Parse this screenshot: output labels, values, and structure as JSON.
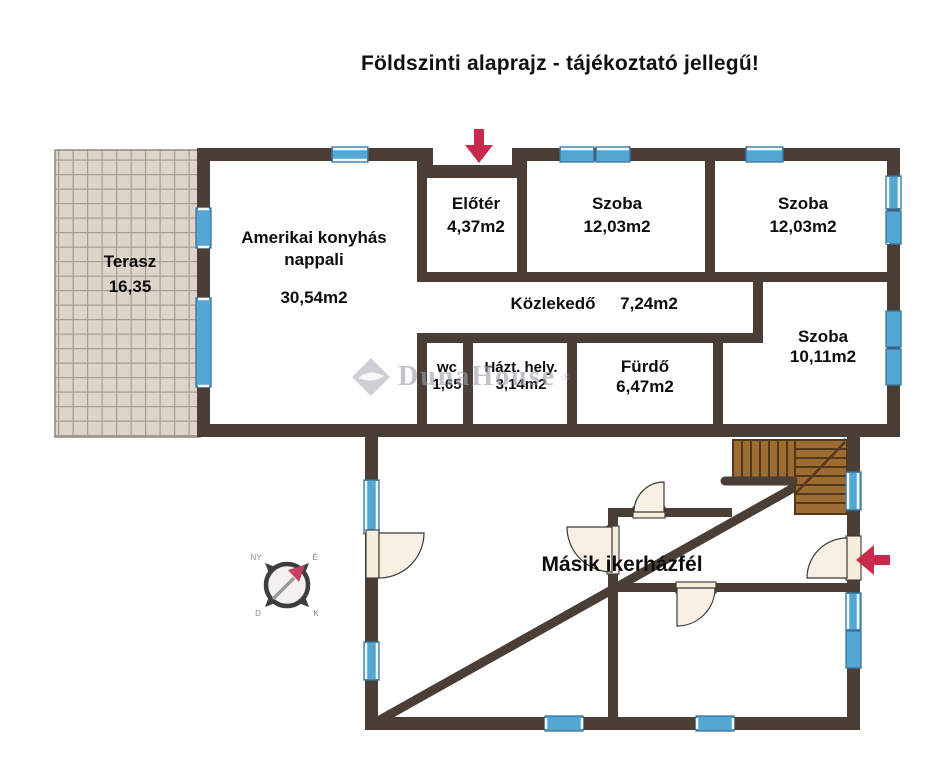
{
  "title": "Földszinti alaprajz - tájékoztató jellegű!",
  "rooms": {
    "terasz": {
      "name": "Terasz",
      "area": "16,35"
    },
    "nappali": {
      "name": "Amerikai konyhás nappali",
      "area": "30,54m2"
    },
    "eloter": {
      "name": "Előtér",
      "area": "4,37m2"
    },
    "szoba1": {
      "name": "Szoba",
      "area": "12,03m2"
    },
    "szoba2": {
      "name": "Szoba",
      "area": "12,03m2"
    },
    "kozlekedo": {
      "name": "Közlekedő",
      "area": "7,24m2"
    },
    "wc": {
      "name": "wc",
      "area": "1,65"
    },
    "hazt": {
      "name": "Házt. hely.",
      "area": "3,14m2"
    },
    "furdo": {
      "name": "Fürdő",
      "area": "6,47m2"
    },
    "szoba3": {
      "name": "Szoba",
      "area": "10,11m2"
    }
  },
  "other_half": {
    "label": "Másik ikerházfél"
  },
  "watermark": {
    "brand": "DunaHouse",
    "registered": "®"
  },
  "compass": {
    "n": "É",
    "e": "K",
    "s": "D",
    "w": "NY"
  },
  "colors": {
    "wall": "#4a3e37",
    "window_blue": "#55a7d3",
    "stairs_brown": "#9c6c33",
    "accent_red": "#c92a4c",
    "tile_beige": "#ded5ca"
  }
}
